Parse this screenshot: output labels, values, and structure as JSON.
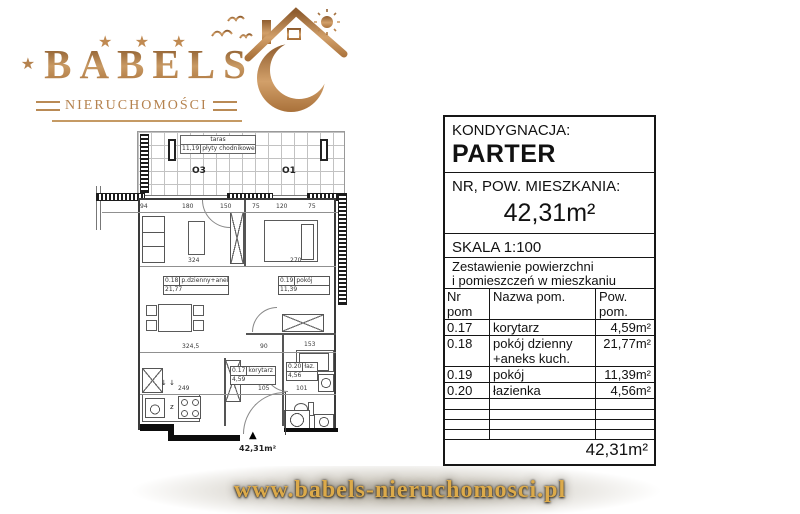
{
  "logo": {
    "stars_top": "★ ★ ★",
    "star_left": "★",
    "star_right": "★",
    "brand": "BABELS",
    "subtitle": "NIERUCHOMOŚCI"
  },
  "floor_plan": {
    "terrace": {
      "name": "taras",
      "area": "11,19",
      "surface": "płyty chodnikowe"
    },
    "windows": {
      "o3": "O3",
      "o1": "O1"
    },
    "dims": {
      "top": [
        "94",
        "180",
        "150",
        "75",
        "120",
        "75"
      ],
      "rooms": [
        "324",
        "270"
      ],
      "mid": [
        "324,5",
        "90",
        "153"
      ],
      "bottom": [
        "249",
        "105",
        "101"
      ]
    },
    "labels": {
      "living": {
        "nr": "0.18",
        "name": "p.dzienny+aneks",
        "area": "21,77"
      },
      "bedroom": {
        "nr": "0.19",
        "name": "pokój",
        "area": "11,39"
      },
      "corridor": {
        "nr": "0.17",
        "name": "korytarz",
        "area": "4,59"
      },
      "bathroom": {
        "nr": "0.20",
        "name": "łaz.",
        "area": "4,56"
      }
    },
    "kitchen_mark": "z",
    "arrows": "↓ ↓",
    "entrance_triangle": "▲",
    "entrance_area": "42,31m²"
  },
  "info_panel": {
    "floor": {
      "label": "KONDYGNACJA:",
      "value": "PARTER"
    },
    "apartment": {
      "label": "NR, POW. MIESZKANIA:",
      "value": "42,31m²"
    },
    "scale": "SKALA 1:100",
    "summary_title_line1": "Zestawienie powierzchni",
    "summary_title_line2": "i pomieszczeń w mieszkaniu",
    "columns": {
      "nr": "Nr pom",
      "name": "Nazwa pom.",
      "area": "Pow. pom."
    },
    "rows": [
      {
        "nr": "0.17",
        "name": "korytarz",
        "area": "4,59m²"
      },
      {
        "nr": "0.18",
        "name": "pokój dzienny +aneks kuch.",
        "area": "21,77m²"
      },
      {
        "nr": "0.19",
        "name": "pokój",
        "area": "11,39m²"
      },
      {
        "nr": "0.20",
        "name": "łazienka",
        "area": "4,56m²"
      }
    ],
    "total": "42,31m²"
  },
  "footer": {
    "url": "www.babels-nieruchomosci.pl"
  }
}
